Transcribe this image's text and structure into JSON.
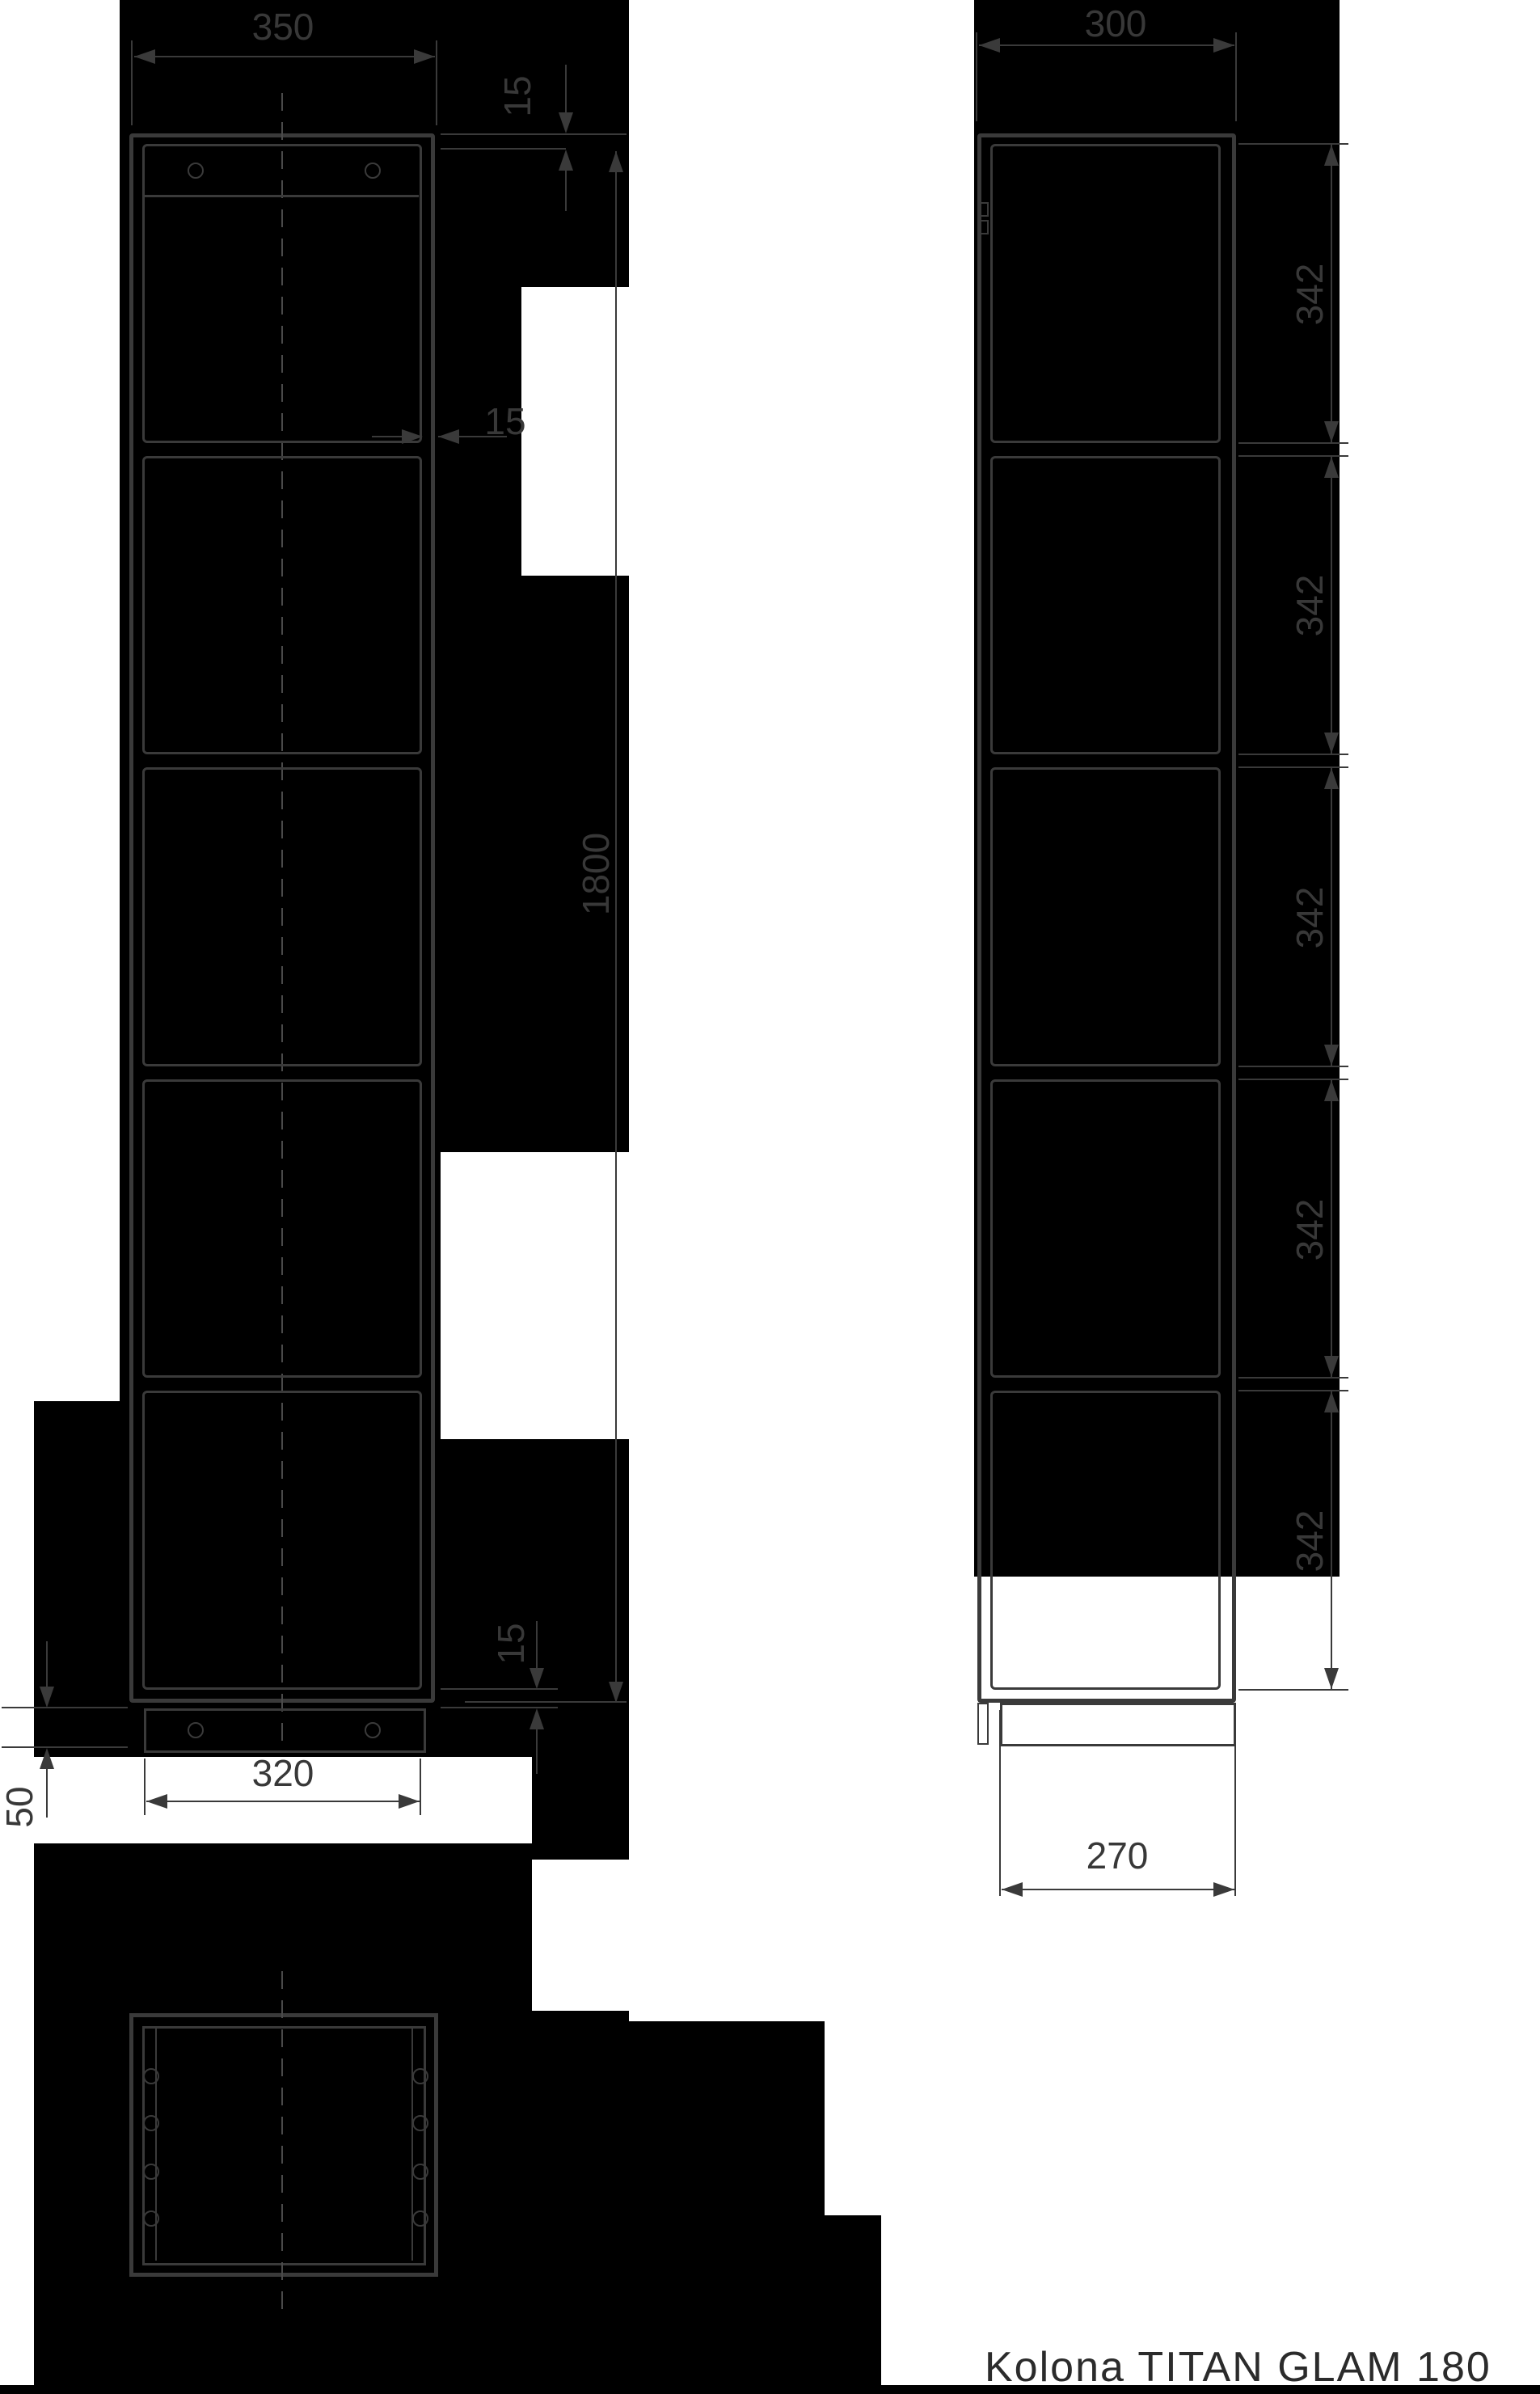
{
  "caption": "Kolona TITAN GLAM 180",
  "front_view": {
    "width_label": "350",
    "height_label": "1800",
    "top_gap_label": "15",
    "side_gap_label": "15",
    "bottom_gap_label": "15",
    "plinth_height_label": "50",
    "door_width_label": "320"
  },
  "side_view": {
    "depth_label": "300",
    "section_labels": [
      "342",
      "342",
      "342",
      "342",
      "342"
    ],
    "plinth_depth_label": "270"
  },
  "colors": {
    "background": "#000000",
    "paper": "#ffffff",
    "line": "#3a3a3a",
    "text": "#383838"
  }
}
